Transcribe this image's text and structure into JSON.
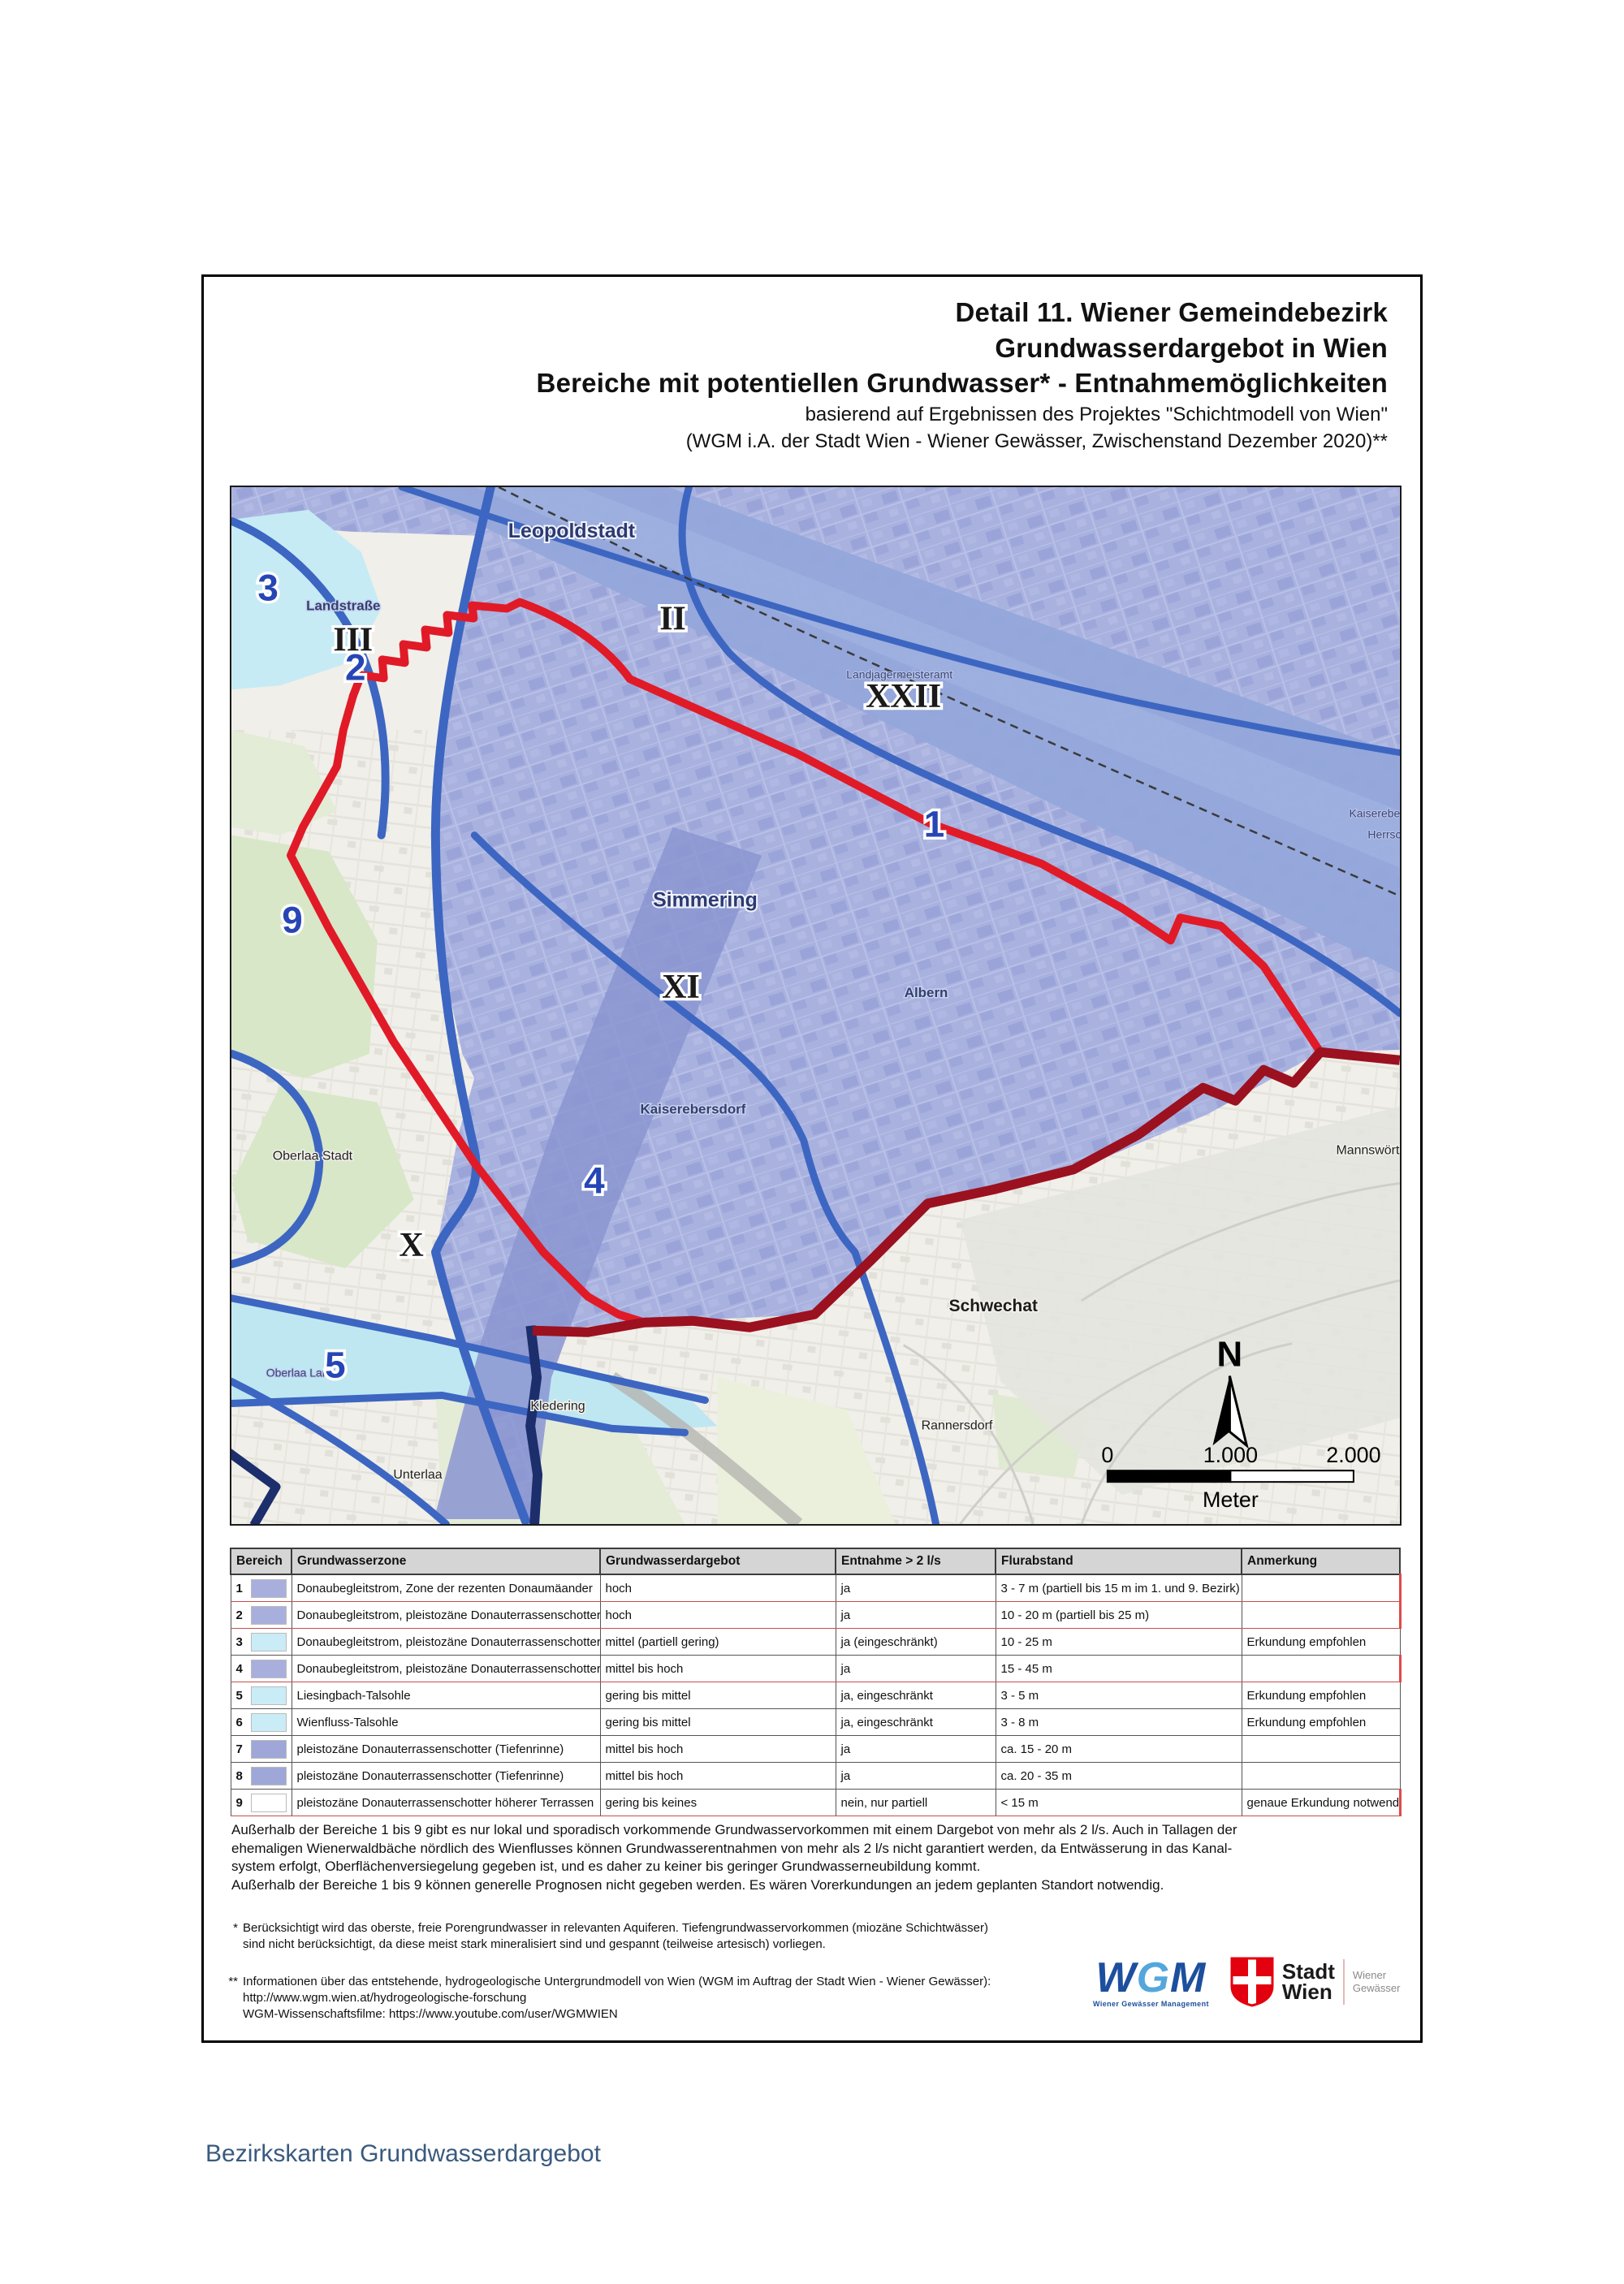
{
  "header": {
    "title_line1": "Detail 11. Wiener Gemeindebezirk",
    "title_line2": "Grundwasserdargebot in Wien",
    "title_line3": "Bereiche mit potentiellen Grundwasser* - Entnahmemöglichkeiten",
    "subtitle_line1": "basierend auf Ergebnissen des Projektes \"Schichtmodell von Wien\"",
    "subtitle_line2": "(WGM i.A. der Stadt Wien - Wiener Gewässer, Zwischenstand Dezember 2020)**"
  },
  "map": {
    "zone_numbers": {
      "n1": "1",
      "n2": "2",
      "n3": "3",
      "n4": "4",
      "n5": "5",
      "n9": "9"
    },
    "districts_roman": {
      "r2": "II",
      "r3": "III",
      "r10": "X",
      "r11": "XI",
      "r22": "XXII"
    },
    "places": {
      "leopoldstadt": "Leopoldstadt",
      "landstrasse": "Landstraße",
      "simmering": "Simmering",
      "albern": "Albern",
      "kaiserebersdorf": "Kaiserebersdorf",
      "landjagermeisteramt": "Landjagermeisteramt",
      "schwechat": "Schwechat",
      "rannersdorf": "Rannersdorf",
      "kledering": "Kledering",
      "unterlaa": "Unterlaa",
      "oberlaa_stadt": "Oberlaa Stadt",
      "oberlaa_land": "Oberlaa Land",
      "mannswoerth": "Mannswörth",
      "kaiserebe_clip": "Kaiserebe",
      "herrsch_clip": "Herrsch"
    },
    "north_label": "N",
    "scale": {
      "t0": "0",
      "t1": "1.000",
      "t2": "2.000",
      "unit": "Meter"
    }
  },
  "table": {
    "headers": [
      "Bereich",
      "Grundwasserzone",
      "Grundwasserdargebot",
      "Entnahme > 2 l/s",
      "Flurabstand",
      "Anmerkung"
    ],
    "rows": [
      {
        "num": "1",
        "color": "#a9afdd",
        "highlight": true,
        "zone": "Donaubegleitstrom, Zone der rezenten Donaumäander",
        "dargebot": "hoch",
        "entnahme": "ja",
        "flurabstand": "3 - 7 m  (partiell bis 15 m im 1. und 9. Bezirk)",
        "anmerkung": ""
      },
      {
        "num": "2",
        "color": "#a9afdd",
        "highlight": true,
        "zone": "Donaubegleitstrom, pleistozäne Donauterrassenschotter",
        "dargebot": "hoch",
        "entnahme": "ja",
        "flurabstand": "10 - 20 m (partiell bis 25 m)",
        "anmerkung": ""
      },
      {
        "num": "3",
        "color": "#c9ecf7",
        "highlight": false,
        "zone": "Donaubegleitstrom, pleistozäne Donauterrassenschotter",
        "dargebot": "mittel  (partiell gering)",
        "entnahme": "ja (eingeschränkt)",
        "flurabstand": "10 - 25 m",
        "anmerkung": "Erkundung empfohlen"
      },
      {
        "num": "4",
        "color": "#a9afdd",
        "highlight": true,
        "zone": "Donaubegleitstrom, pleistozäne Donauterrassenschotter",
        "dargebot": "mittel bis hoch",
        "entnahme": "ja",
        "flurabstand": "15 - 45 m",
        "anmerkung": ""
      },
      {
        "num": "5",
        "color": "#c9ecf7",
        "highlight": false,
        "zone": "Liesingbach-Talsohle",
        "dargebot": "gering bis mittel",
        "entnahme": "ja, eingeschränkt",
        "flurabstand": "3 - 5 m",
        "anmerkung": "Erkundung empfohlen"
      },
      {
        "num": "6",
        "color": "#c9ecf7",
        "highlight": false,
        "zone": "Wienfluss-Talsohle",
        "dargebot": "gering bis mittel",
        "entnahme": "ja, eingeschränkt",
        "flurabstand": "3 - 8 m",
        "anmerkung": "Erkundung empfohlen"
      },
      {
        "num": "7",
        "color": "#9ea7d8",
        "highlight": false,
        "zone": "pleistozäne Donauterrassenschotter (Tiefenrinne)",
        "dargebot": "mittel bis hoch",
        "entnahme": "ja",
        "flurabstand": "ca. 15 - 20 m",
        "anmerkung": ""
      },
      {
        "num": "8",
        "color": "#9ea7d8",
        "highlight": false,
        "zone": "pleistozäne Donauterrassenschotter (Tiefenrinne)",
        "dargebot": "mittel bis hoch",
        "entnahme": "ja",
        "flurabstand": "ca. 20 - 35 m",
        "anmerkung": ""
      },
      {
        "num": "9",
        "color": "#ffffff",
        "highlight": true,
        "zone": "pleistozäne Donauterrassenschotter höherer Terrassen",
        "dargebot": "gering bis keines",
        "entnahme": "nein, nur partiell",
        "flurabstand": "< 15 m",
        "anmerkung": "genaue Erkundung notwendig"
      }
    ]
  },
  "notes": {
    "body": "Außerhalb der Bereiche 1 bis 9 gibt es nur lokal und sporadisch vorkommende Grundwasservorkommen mit einem Dargebot von mehr als 2 l/s. Auch in Tallagen der\nehemaligen Wienerwaldbäche nördlich des Wienflusses können Grundwasserentnahmen von mehr als 2 l/s nicht garantiert werden, da Entwässerung in das Kanal-\nsystem erfolgt, Oberflächenversiegelung gegeben ist, und es daher zu keiner bis geringer Grundwasserneubildung kommt.\nAußerhalb der Bereiche 1 bis 9 können generelle Prognosen nicht gegeben werden. Es wären Vorerkundungen an jedem geplanten Standort notwendig.",
    "fn1_mark": "*",
    "fn1_text": "Berücksichtigt wird das oberste, freie Porengrundwasser in relevanten Aquiferen. Tiefengrundwasservorkommen (miozäne Schichtwässer)\nsind nicht berücksichtigt, da diese meist stark mineralisiert sind und gespannt (teilweise artesisch) vorliegen.",
    "fn2_mark": "**",
    "fn2_text": "Informationen über das entstehende, hydrogeologische Untergrundmodell von Wien (WGM im Auftrag der Stadt Wien - Wiener Gewässer):\nhttp://www.wgm.wien.at/hydrogeologische-forschung\nWGM-Wissenschaftsfilme: https://www.youtube.com/user/WGMWIEN"
  },
  "logos": {
    "wgm": {
      "l1": "W",
      "l2": "G",
      "l3": "M",
      "subtitle": "Wiener Gewässer Management"
    },
    "stadt_wien": {
      "line1": "Stadt",
      "line2": "Wien",
      "right1": "Wiener",
      "right2": "Gewässer"
    }
  },
  "page": {
    "caption": "Bezirkskarten Grundwasserdargebot"
  },
  "colors": {
    "boundary_red": "#e11a28",
    "boundary_dark_red": "#9b1120",
    "boundary_blue": "#3c66c1",
    "boundary_navy": "#1c2e6b",
    "zone_periwinkle": "#a9b2df",
    "zone_danube_band": "#93a6da",
    "zone_cyan": "#c6ebf5",
    "zone_tiefenrinne": "#8b95d1",
    "caption_blue": "#3a5a7e",
    "wgm_blue": "#1c4f9e",
    "wien_red": "#e3000f"
  }
}
